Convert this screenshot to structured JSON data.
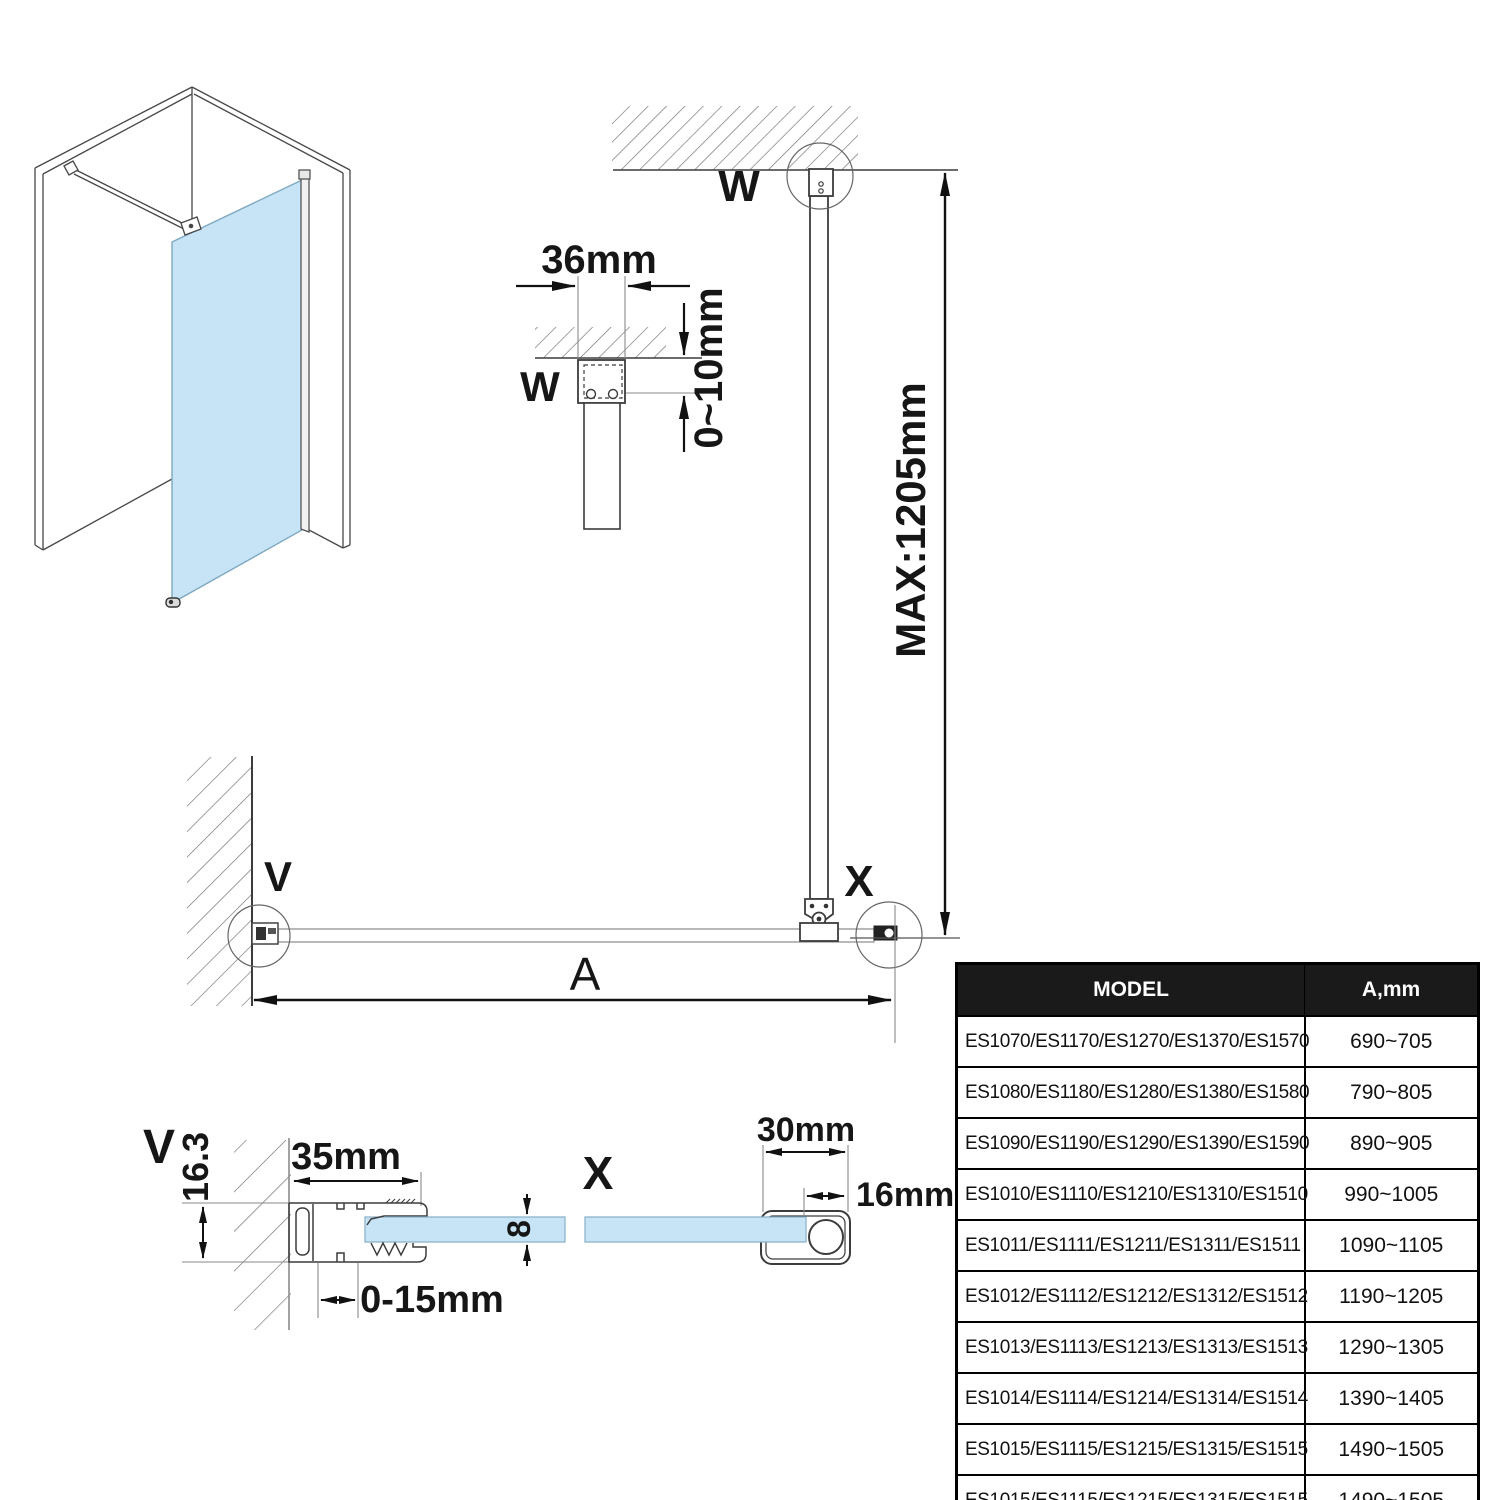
{
  "diagram": {
    "labels": {
      "w": "W",
      "v": "V",
      "x": "X",
      "a": "A"
    },
    "dimensions": {
      "bracket_width": "36mm",
      "ceiling_gap": "0~10mm",
      "bar_max_length": "MAX:1205mm",
      "profile_depth": "16.3",
      "profile_width": "35mm",
      "glass_thickness": "8",
      "adjustment_range": "0-15mm",
      "clamp_width": "30mm",
      "clamp_bar": "16mm"
    }
  },
  "table": {
    "headers": [
      "MODEL",
      "A,mm"
    ],
    "rows": [
      {
        "model": "ES1070/ES1170/ES1270/ES1370/ES1570",
        "a": "690~705"
      },
      {
        "model": "ES1080/ES1180/ES1280/ES1380/ES1580",
        "a": "790~805"
      },
      {
        "model": "ES1090/ES1190/ES1290/ES1390/ES1590",
        "a": "890~905"
      },
      {
        "model": "ES1010/ES1110/ES1210/ES1310/ES1510",
        "a": "990~1005"
      },
      {
        "model": "ES1011/ES1111/ES1211/ES1311/ES1511",
        "a": "1090~1105"
      },
      {
        "model": "ES1012/ES1112/ES1212/ES1312/ES1512",
        "a": "1190~1205"
      },
      {
        "model": "ES1013/ES1113/ES1213/ES1313/ES1513",
        "a": "1290~1305"
      },
      {
        "model": "ES1014/ES1114/ES1214/ES1314/ES1514",
        "a": "1390~1405"
      },
      {
        "model": "ES1015/ES1115/ES1215/ES1315/ES1515",
        "a": "1490~1505"
      },
      {
        "model": "ES1015/ES1115/ES1215/ES1315/ES1515",
        "a": "1490~1505"
      }
    ]
  },
  "colors": {
    "glass": "#c6e4f6",
    "line": "#3c3c3c",
    "dim": "#111111",
    "table_header_bg": "#1a1a1a",
    "table_header_text": "#ffffff"
  }
}
